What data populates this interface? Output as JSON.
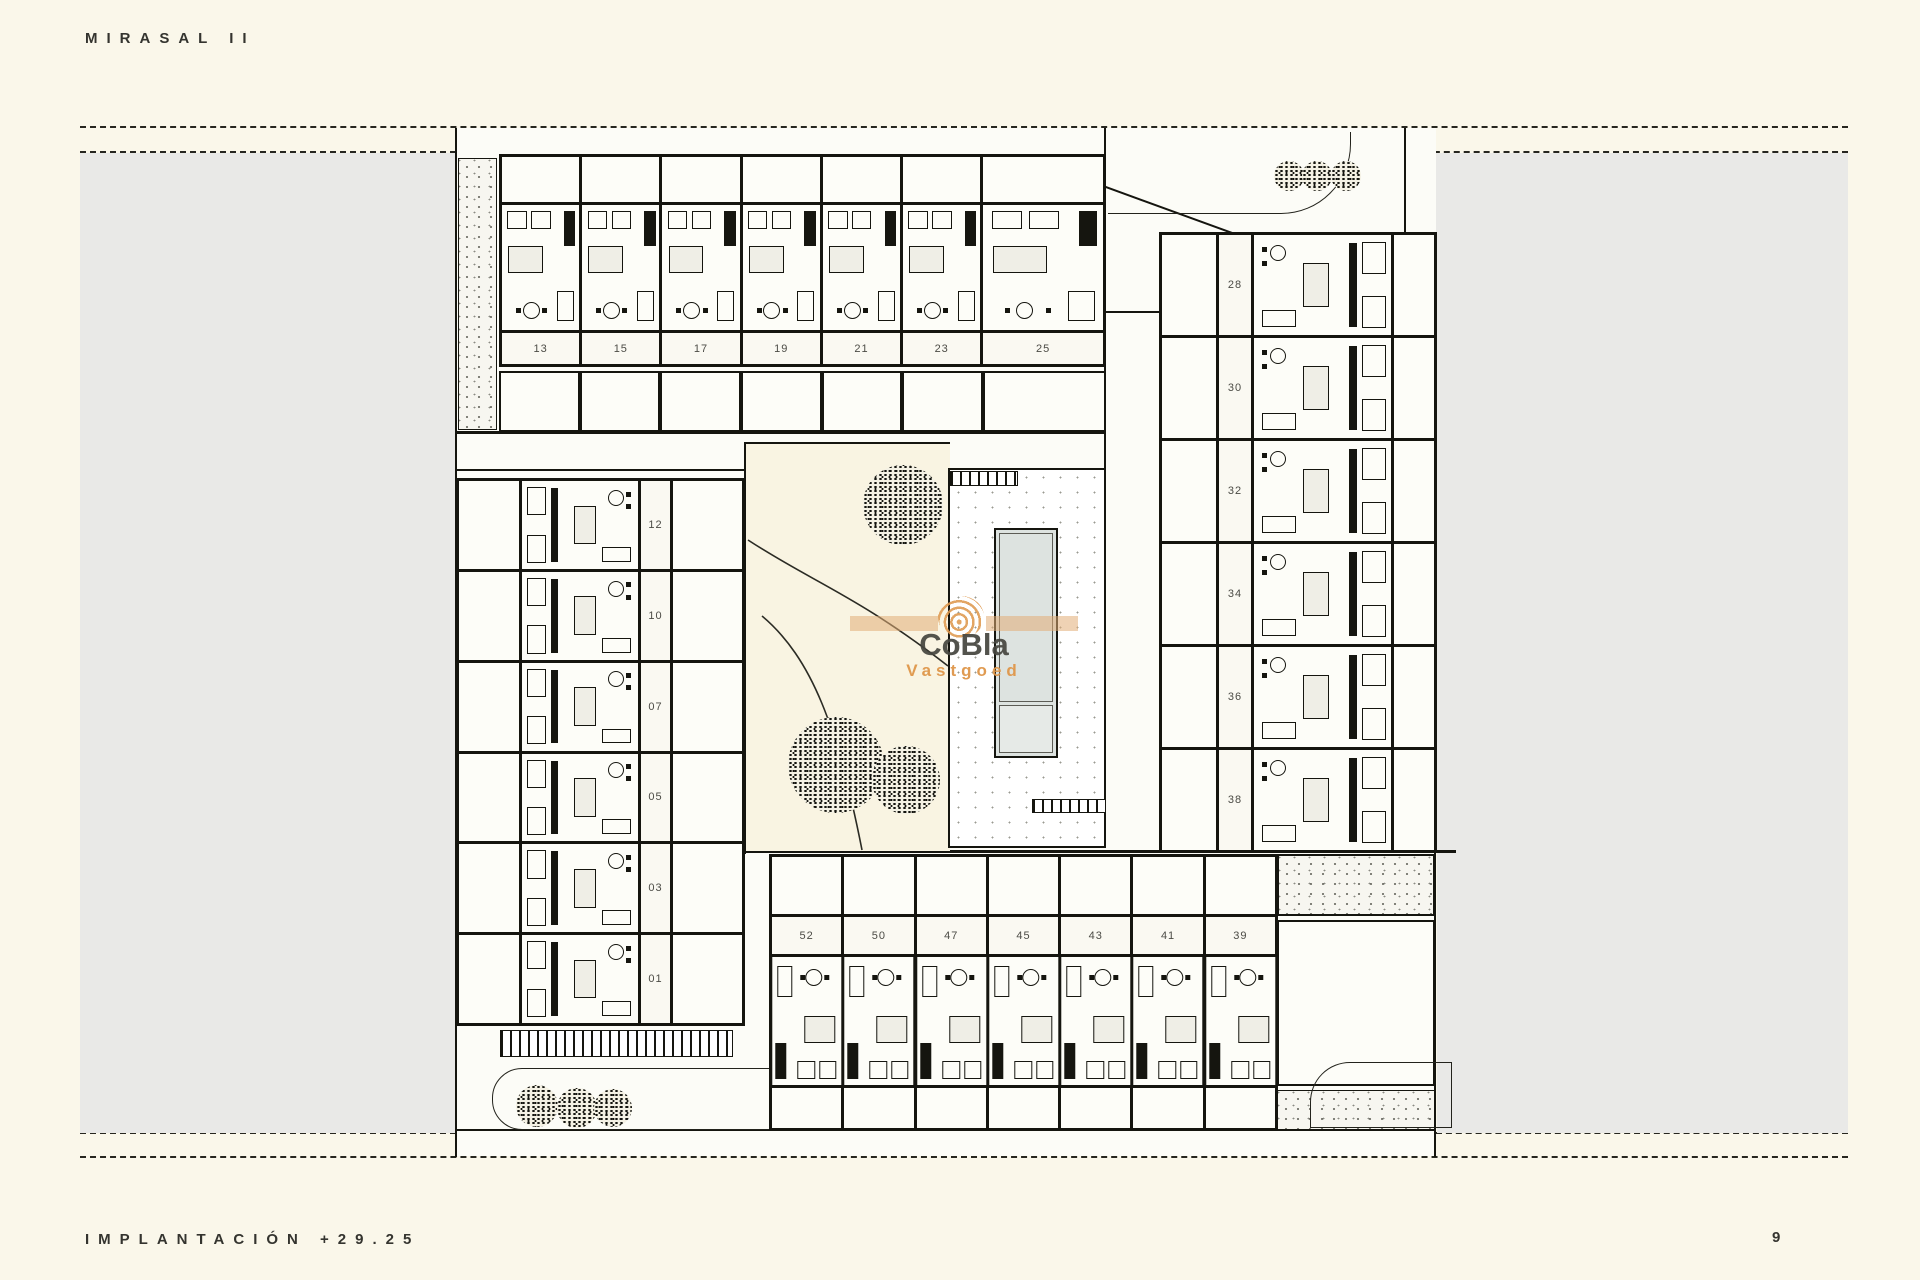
{
  "page": {
    "title": "MIRASAL II",
    "footer_left": "IMPLANTACIÓN +29.25",
    "page_number": "9"
  },
  "watermark": {
    "brand": "CoBla",
    "sub": "Vastgoed",
    "accent_color": "#de984a",
    "text_color": "#46463f"
  },
  "plan": {
    "drawing_type": "site implantation floor plan",
    "unit_blocks": {
      "top_row": [
        "13",
        "15",
        "17",
        "19",
        "21",
        "23",
        "25"
      ],
      "right_column": [
        "28",
        "30",
        "32",
        "34",
        "36",
        "38"
      ],
      "left_column": [
        "12",
        "10",
        "07",
        "05",
        "03",
        "01"
      ],
      "bottom_row": [
        "52",
        "50",
        "47",
        "45",
        "43",
        "41",
        "39"
      ]
    }
  },
  "colors": {
    "page_background": "#faf7ea",
    "parcel_gray": "#e9e9e7",
    "plan_white": "#fcfcf7",
    "garden_cream": "#f9f4e2",
    "pool_water": "#dde3e0",
    "line_ink": "#15150f"
  }
}
